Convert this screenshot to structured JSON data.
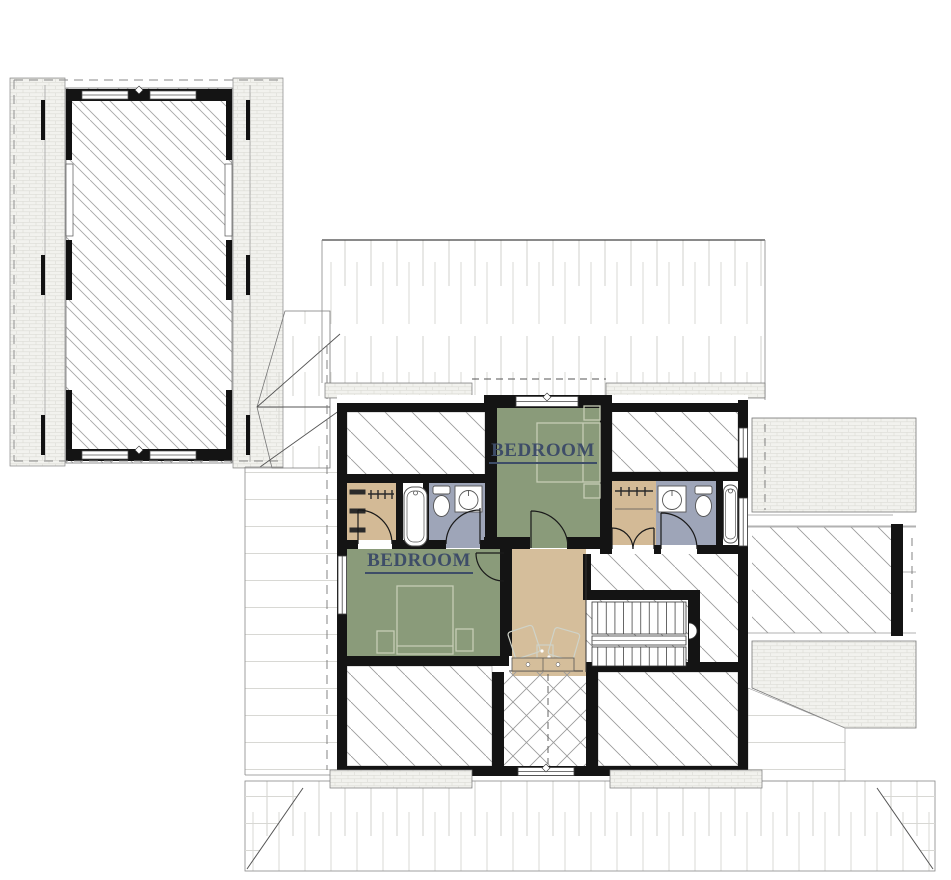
{
  "rooms": {
    "bedroom_top": {
      "label": "BEDROOM"
    },
    "bedroom_left": {
      "label": "BEDROOM"
    }
  },
  "colors": {
    "paper": "#FFFFFF",
    "bedroom_fill": "#8A9B7A",
    "closet_fill": "#D3BA96",
    "bathroom_fill": "#9EA5B8",
    "hall_fill": "#D5BE9B",
    "label_color": "#3E4D68",
    "wall_color": "#141414",
    "hatch_line": "#9B9B9B",
    "roof_line": "#CBCBC7",
    "shingle_bg": "#F2F2EE",
    "fixture_line": "#555555",
    "furniture_line": "#C6CDB6"
  }
}
